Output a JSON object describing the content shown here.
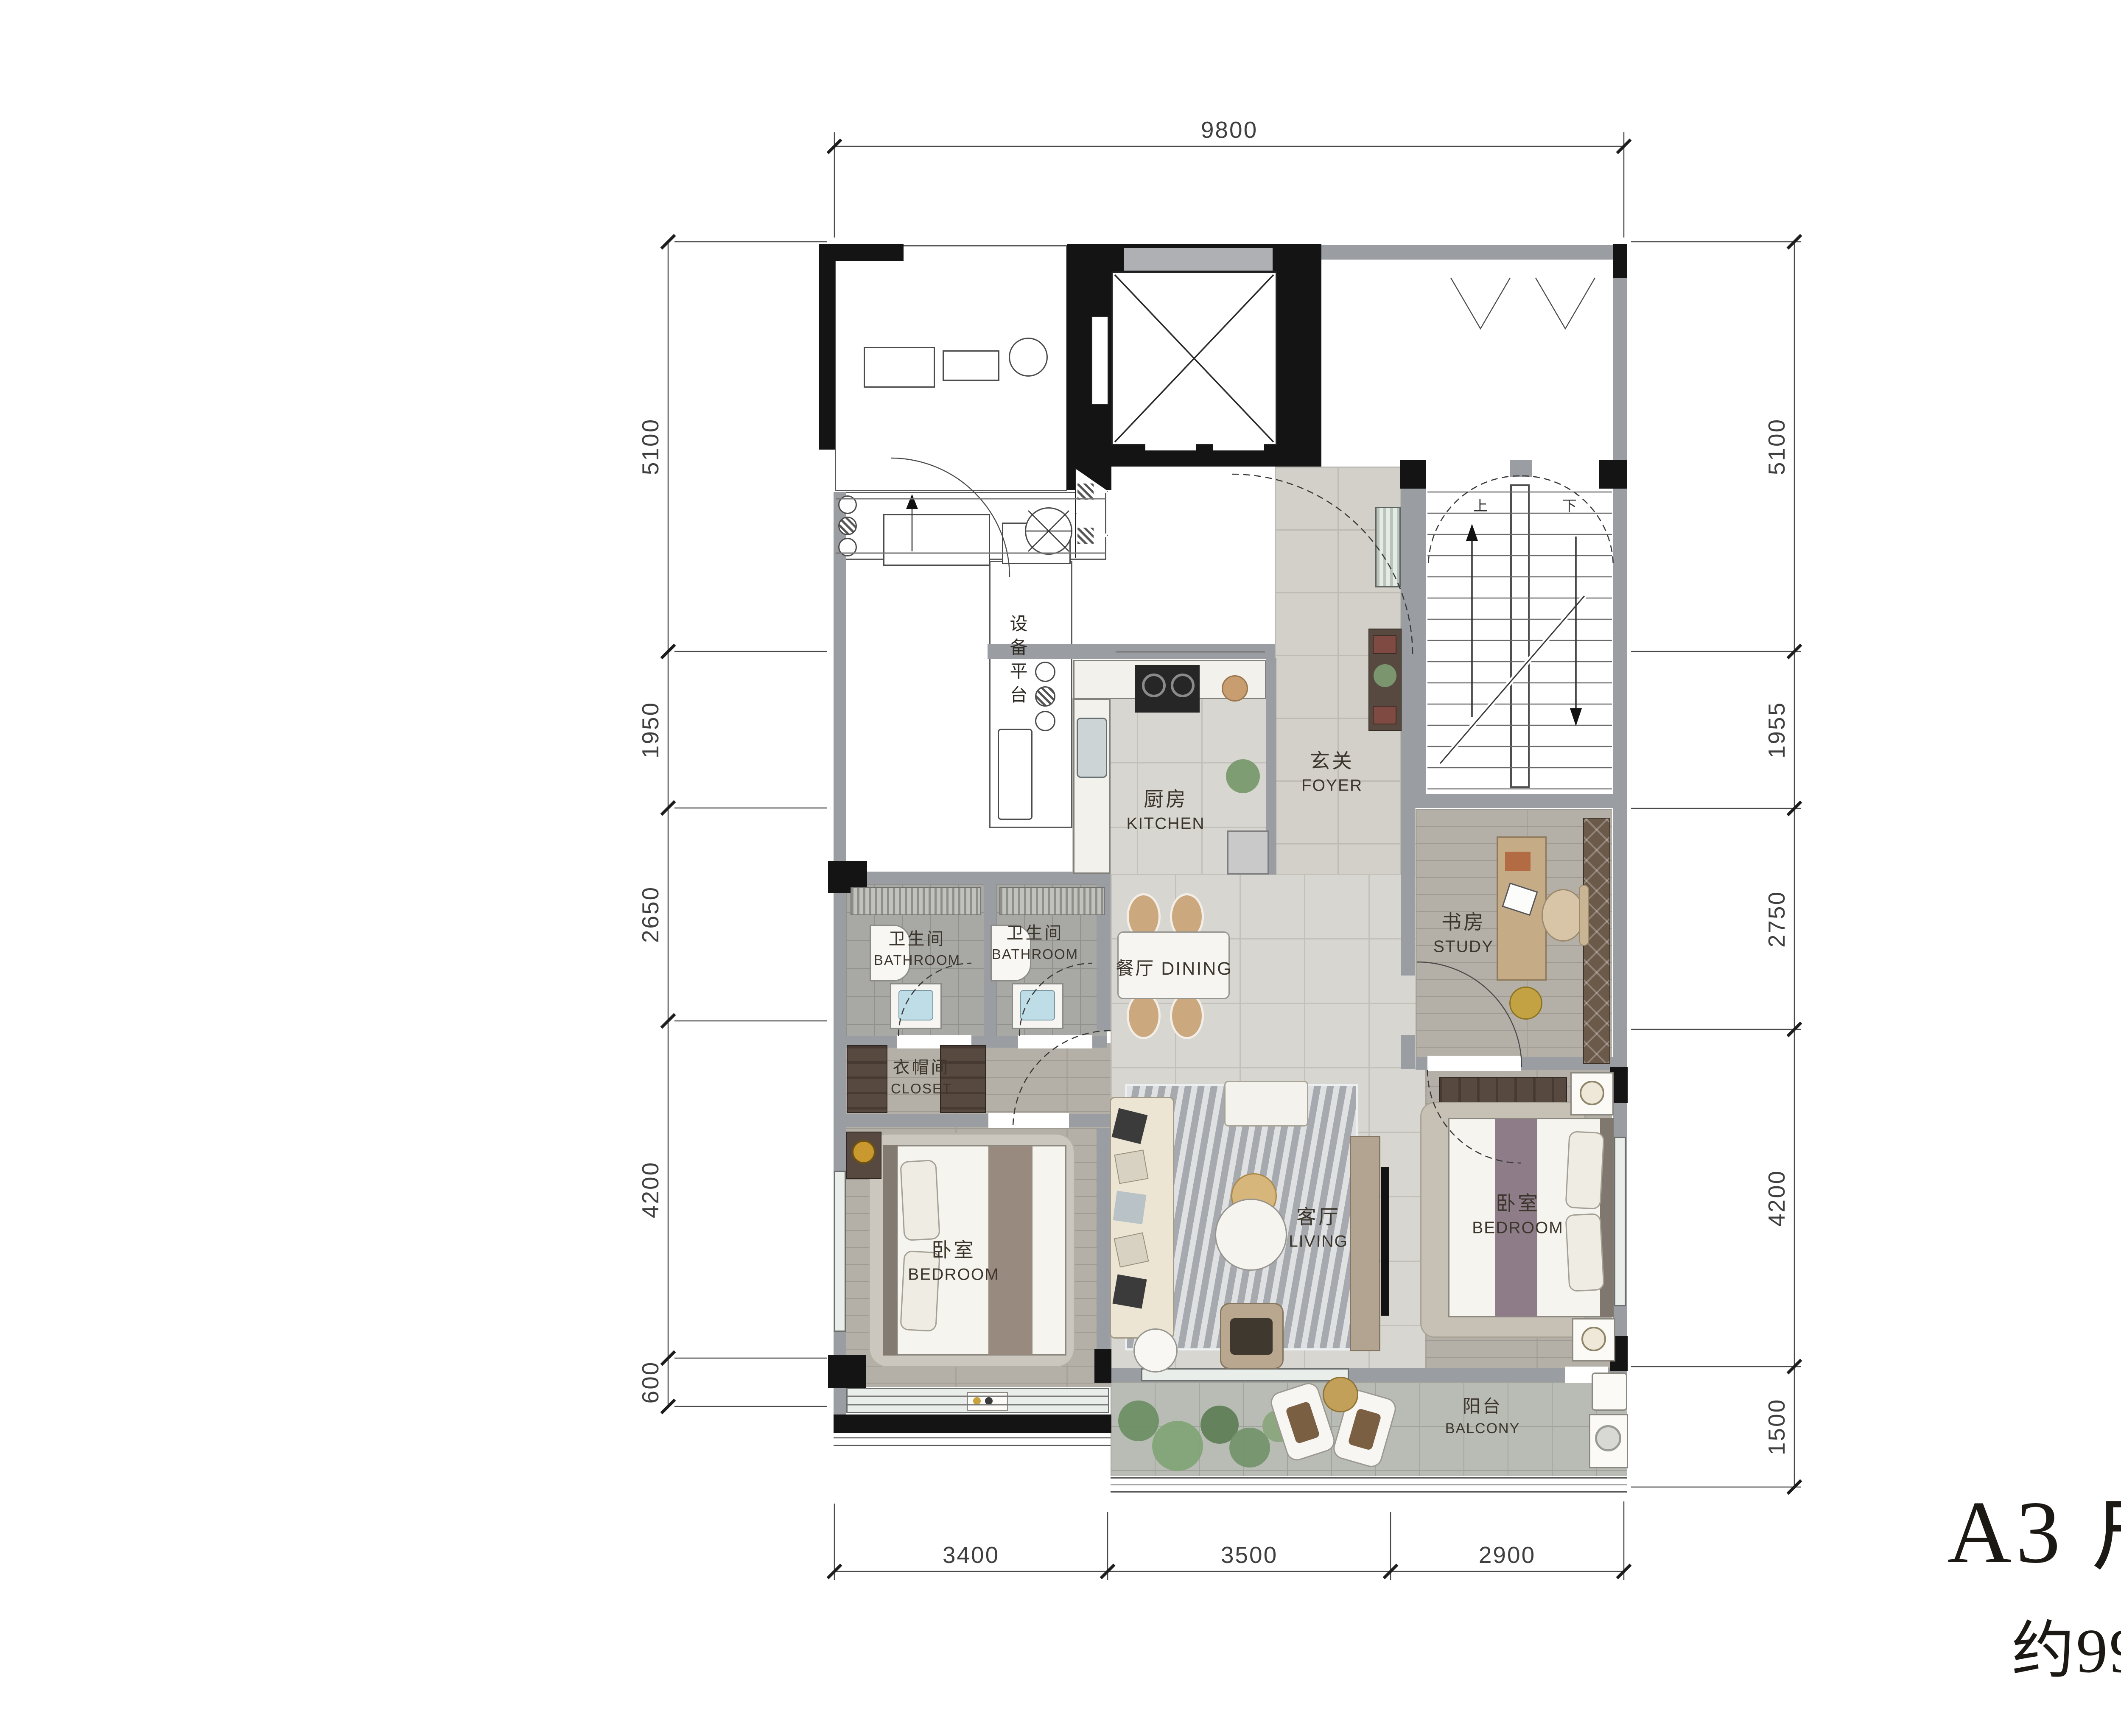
{
  "title": {
    "name": "A3 户型",
    "area_prefix": "约",
    "area_value": "99",
    "area_unit": "m²"
  },
  "logo": {
    "brand": "浙里选房"
  },
  "dimensions": {
    "top": {
      "total": "9800"
    },
    "bottom": {
      "seg1": "3400",
      "seg2": "3500",
      "seg3": "2900"
    },
    "left": {
      "seg1": "5100",
      "seg2": "1950",
      "seg3": "2650",
      "seg4": "4200",
      "seg5": "600"
    },
    "right": {
      "seg1": "5100",
      "seg2": "1955",
      "seg3": "2750",
      "seg4": "4200",
      "seg5": "1500"
    }
  },
  "rooms": {
    "kitchen": {
      "zh": "厨房",
      "en": "KITCHEN"
    },
    "foyer": {
      "zh": "玄关",
      "en": "FOYER"
    },
    "bathroom_a": {
      "zh": "卫生间",
      "en": "BATHROOM"
    },
    "bathroom_b": {
      "zh": "卫生间",
      "en": "BATHROOM"
    },
    "dining": {
      "zh": "餐厅",
      "en": "DINING"
    },
    "study": {
      "zh": "书房",
      "en": "STUDY"
    },
    "closet": {
      "zh": "衣帽间",
      "en": "CLOSET"
    },
    "bedroom_left": {
      "zh": "卧室",
      "en": "BEDROOM"
    },
    "living": {
      "zh": "客厅",
      "en": "LIVING"
    },
    "bedroom_right": {
      "zh": "卧室",
      "en": "BEDROOM"
    },
    "balcony": {
      "zh": "阳台",
      "en": "BALCONY"
    }
  },
  "annotations": {
    "equipment_platform": "设备平台",
    "stair_up": "上",
    "stair_down": "下"
  },
  "colors": {
    "wall_dark": "#141414",
    "wall_gray": "#9a9da2",
    "logo_green": "#3fa14a",
    "label": "#3b352c"
  }
}
